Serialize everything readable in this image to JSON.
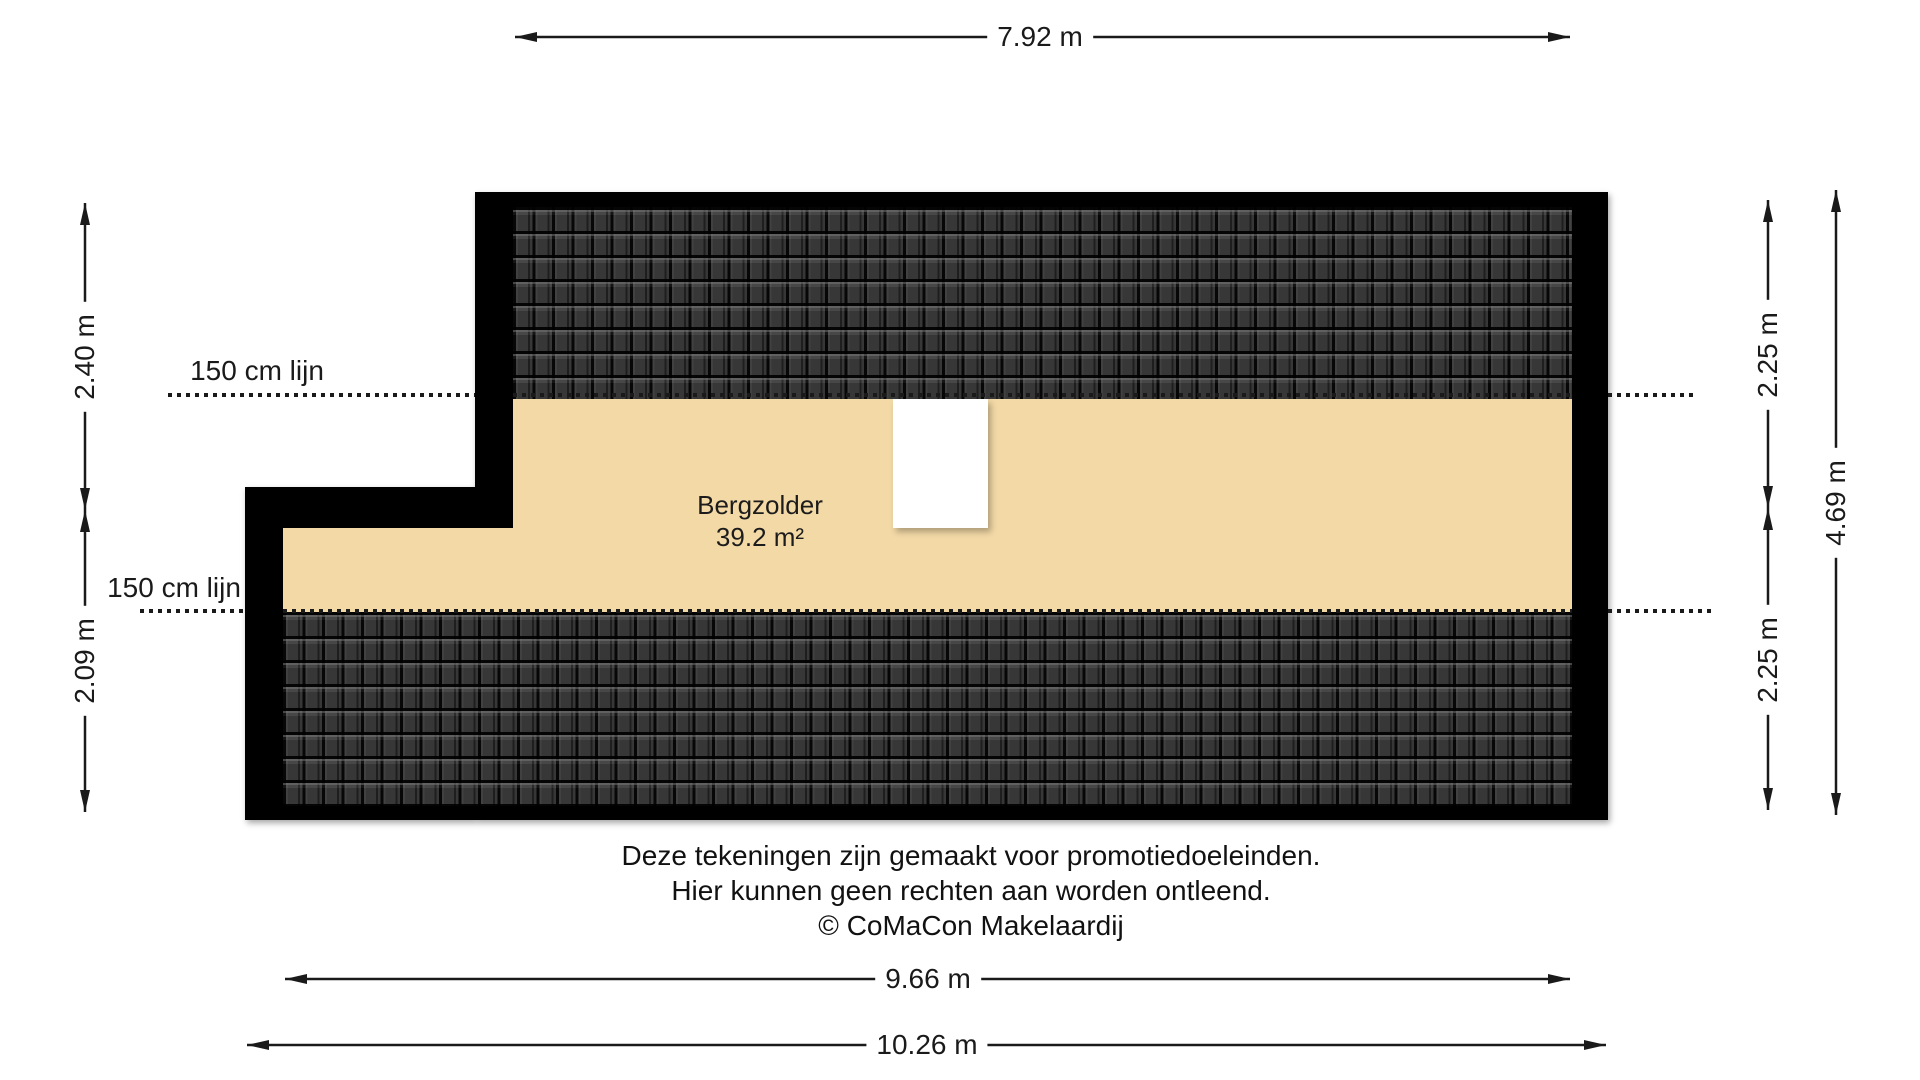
{
  "plan": {
    "room": {
      "name": "Bergzolder",
      "area": "39.2 m²"
    },
    "clearance_lines": {
      "upper_label": "150 cm lijn",
      "lower_label": "150 cm lijn"
    },
    "colors": {
      "wall": "#000000",
      "floor": "#f3d9a6",
      "roof_tile_dark": "#3d3d3d",
      "roof_tile_gap": "#0f0f0f",
      "line_ink": "#1a1a1a",
      "page_bg": "#ffffff"
    }
  },
  "dimensions": {
    "top": {
      "label": "7.92 m"
    },
    "left_upper": {
      "label": "2.40 m"
    },
    "left_lower": {
      "label": "2.09 m"
    },
    "right_inner_upper": {
      "label": "2.25 m"
    },
    "right_inner_lower": {
      "label": "2.25 m"
    },
    "right_outer": {
      "label": "4.69 m"
    },
    "bottom_inner": {
      "label": "9.66 m"
    },
    "bottom_outer": {
      "label": "10.26 m"
    }
  },
  "disclaimer": {
    "lines": [
      "Deze tekeningen zijn gemaakt voor promotiedoeleinden.",
      "Hier kunnen geen rechten aan worden ontleend.",
      "© CoMaCon Makelaardij"
    ]
  }
}
